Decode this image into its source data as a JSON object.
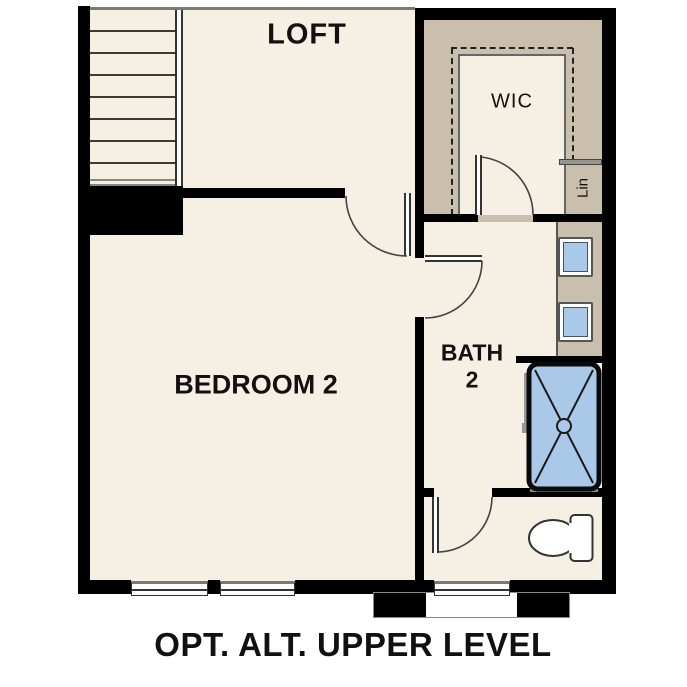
{
  "title": "OPT. ALT. UPPER LEVEL",
  "rooms": {
    "loft": "LOFT",
    "wic": "WIC",
    "linen": "Lin",
    "bedroom": "BEDROOM 2",
    "bath_line1": "BATH",
    "bath_line2": "2"
  },
  "fixtures": {
    "stairs": "staircase",
    "railing": "stair-railing",
    "closet": "wic-shelving",
    "linen_shelf": "linen-shelf",
    "vanity": "vanity-counter",
    "sinks": "two-sinks",
    "shower": "shower-with-x",
    "toilet": "toilet",
    "windows": "three-windows",
    "doors": "four-swing-doors"
  },
  "colors": {
    "floor": "#f6efe4",
    "closet_tan": "#c9bfac",
    "wall": "#000000",
    "fixture_blue": "#a9c9e9",
    "line_gray": "#7a7a72"
  }
}
